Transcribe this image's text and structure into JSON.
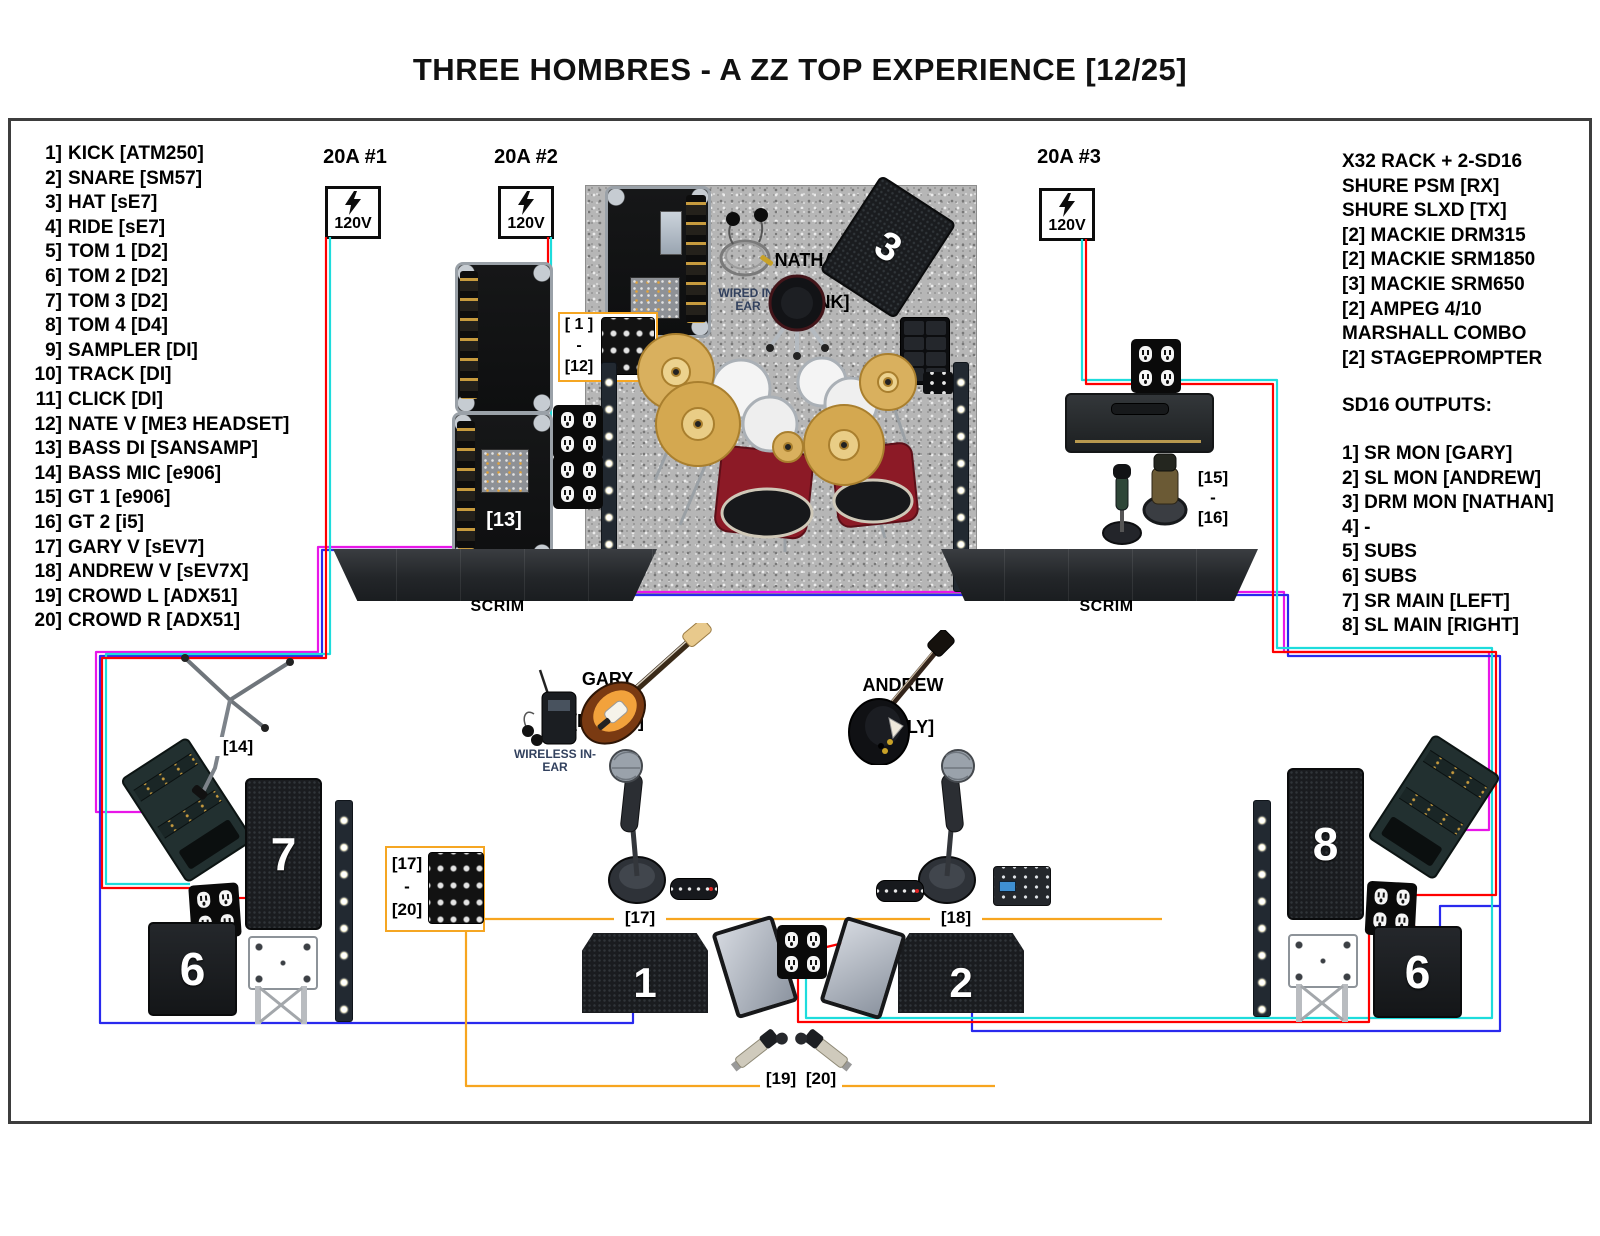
{
  "title": "THREE HOMBRES - A ZZ TOP EXPERIENCE [12/25]",
  "input_list": [
    {
      "num": "1]",
      "label": "KICK [ATM250]"
    },
    {
      "num": "2]",
      "label": "SNARE [SM57]"
    },
    {
      "num": "3]",
      "label": "HAT [sE7]"
    },
    {
      "num": "4]",
      "label": "RIDE [sE7]"
    },
    {
      "num": "5]",
      "label": "TOM 1 [D2]"
    },
    {
      "num": "6]",
      "label": "TOM 2 [D2]"
    },
    {
      "num": "7]",
      "label": "TOM 3 [D2]"
    },
    {
      "num": "8]",
      "label": "TOM 4 [D4]"
    },
    {
      "num": "9]",
      "label": "SAMPLER [DI]"
    },
    {
      "num": "10]",
      "label": "TRACK [DI]"
    },
    {
      "num": "11]",
      "label": "CLICK [DI]"
    },
    {
      "num": "12]",
      "label": "NATE V [ME3 HEADSET]"
    },
    {
      "num": "13]",
      "label": "BASS DI [SANSAMP]"
    },
    {
      "num": "14]",
      "label": "BASS MIC [e906]"
    },
    {
      "num": "15]",
      "label": "GT 1 [e906]"
    },
    {
      "num": "16]",
      "label": "GT 2 [i5]"
    },
    {
      "num": "17]",
      "label": "GARY V [sEV7]"
    },
    {
      "num": "18]",
      "label": "ANDREW V [sEV7X]"
    },
    {
      "num": "19]",
      "label": "CROWD L [ADX51]"
    },
    {
      "num": "20]",
      "label": "CROWD R [ADX51]"
    }
  ],
  "equipment_list": [
    "X32 RACK + 2-SD16",
    "SHURE PSM [RX]",
    "SHURE SLXD [TX]",
    "[2] MACKIE DRM315",
    "[2] MACKIE SRM1850",
    "[3] MACKIE SRM650",
    "[2] AMPEG 4/10",
    "MARSHALL COMBO",
    "[2] STAGEPROMPTER"
  ],
  "sd16": {
    "heading": "SD16 OUTPUTS:",
    "outputs": [
      "1] SR MON [GARY]",
      "2] SL MON [ANDREW]",
      "3] DRM MON [NATHAN]",
      "4] -",
      "5] SUBS",
      "6] SUBS",
      "7] SR MAIN [LEFT]",
      "8] SL MAIN [RIGHT]"
    ]
  },
  "power_drops": [
    {
      "label": "20A #1",
      "voltage": "120V"
    },
    {
      "label": "20A #2",
      "voltage": "120V"
    },
    {
      "label": "20A #3",
      "voltage": "120V"
    }
  ],
  "performers": {
    "drummer": {
      "name": "NATHAN",
      "alias": "[FRANK]",
      "monitor_note": "WIRED IN-EAR"
    },
    "bassist": {
      "name": "GARY",
      "alias": "[DUSTY]",
      "monitor_note": "WIRELESS IN-EAR"
    },
    "guitarist": {
      "name": "ANDREW",
      "alias": "[BILLY]"
    }
  },
  "stage_labels": {
    "scrim_left": "SCRIM",
    "scrim_right": "SCRIM",
    "snake_1_12": {
      "l1": "[ 1 ]",
      "l2": "-",
      "l3": "[12]"
    },
    "snake_17_20": {
      "l1": "[17]",
      "l2": "-",
      "l3": "[20]"
    },
    "gt_mics": {
      "l1": "[15]",
      "l2": "-",
      "l3": "[16]"
    },
    "bass_di": "[13]",
    "bass_mic": "[14]",
    "gary_vocal": "[17]",
    "andrew_vocal": "[18]",
    "crowd_l": "[19]",
    "crowd_r": "[20]"
  },
  "speakers": {
    "mon_1": "1",
    "mon_2": "2",
    "drum_mon": "3",
    "sub_left": "6",
    "sub_right": "6",
    "main_left": "7",
    "main_right": "8"
  },
  "cable_colors": {
    "power_red": "#ff0000",
    "power_cyan": "#1ddcdc",
    "signal_blue": "#2929ee",
    "signal_magenta": "#e816e8",
    "signal_orange": "#f7a51f"
  }
}
